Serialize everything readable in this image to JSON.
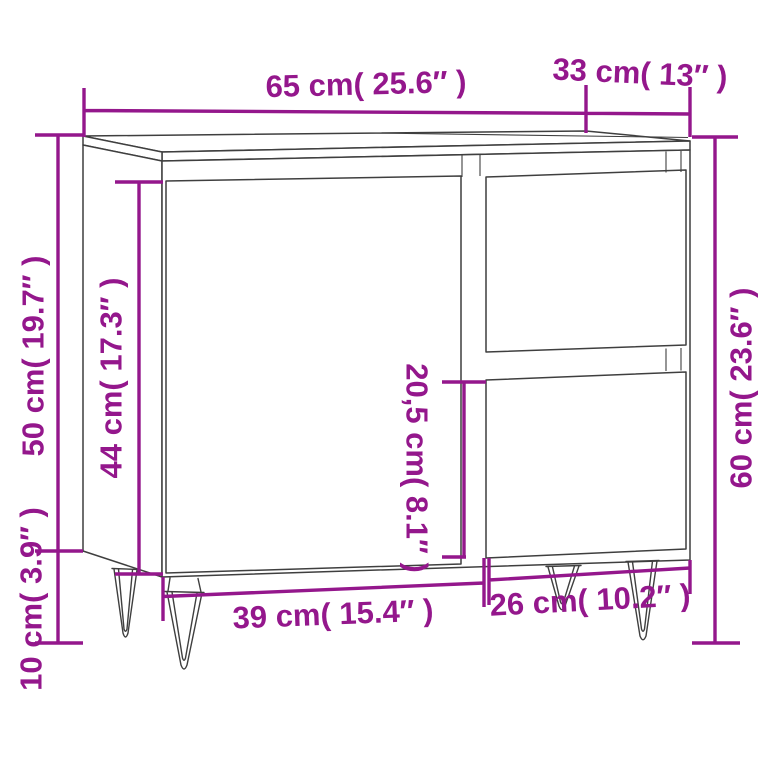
{
  "diagram": {
    "background_color": "#ffffff",
    "accent_color": "#94178C",
    "line_color": "#3f3f3f",
    "product": "Bathroom cabinet with one door, two drawers and four hairpin legs",
    "labels": {
      "width_top": "65 cm( 25.6″ )",
      "depth_top": "33 cm( 13″ )",
      "body_height_left": "50 cm( 19.7″ )",
      "door_height": "44 cm( 17.3″ )",
      "leg_height": "10 cm( 3.9″ )",
      "drawer_height": "20,5 cm( 8.1″ )",
      "total_height_right": "60 cm( 23.6″ )",
      "door_width": "39 cm( 15.4″ )",
      "drawer_width": "26 cm( 10.2″ )"
    }
  }
}
